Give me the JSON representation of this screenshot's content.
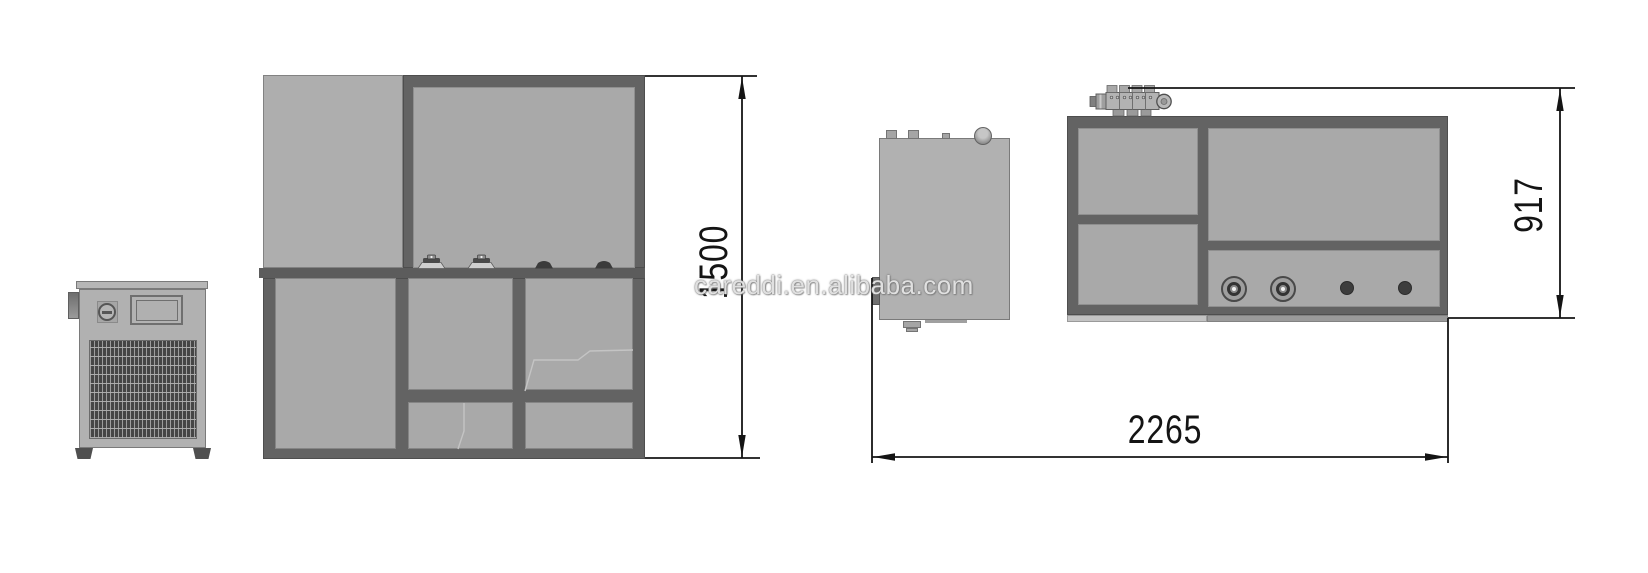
{
  "watermark": {
    "text": "careddi.en.alibaba.com"
  },
  "dimensions": {
    "front_height": {
      "value": "1500",
      "orientation": "vertical",
      "view": "front elevation"
    },
    "top_depth": {
      "value": "917",
      "orientation": "vertical",
      "view": "top plan"
    },
    "top_width": {
      "value": "2265",
      "orientation": "horizontal",
      "view": "top plan"
    }
  },
  "colors": {
    "background": "#ffffff",
    "panel_light": "#a9a9a9",
    "body_gray": "#b1b1b1",
    "frame_dark": "#636363",
    "grille_dark": "#454545",
    "dimension_line": "#141414",
    "watermark_gray": "#9a9a9a"
  }
}
